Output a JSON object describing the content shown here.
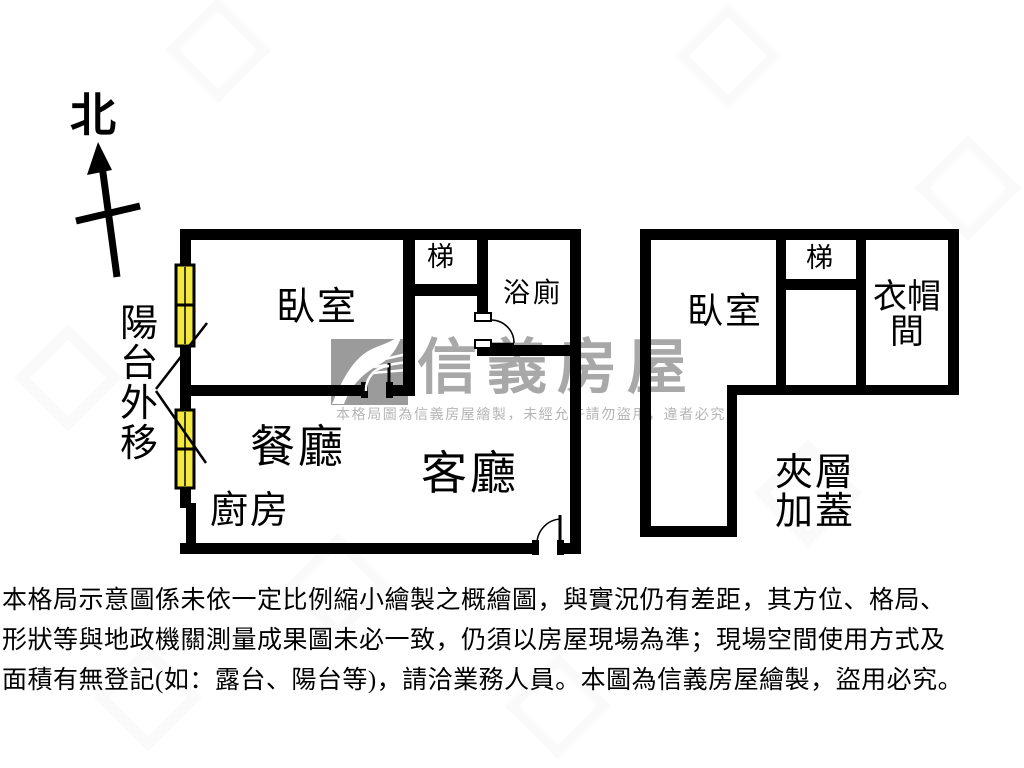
{
  "compass": {
    "label": "北"
  },
  "watermark": {
    "brand": "信義房屋",
    "notice": "本格局圖為信義房屋繪製，未經允許請勿盜用，違者必究",
    "brand_color": "#a8a8a8",
    "logo_color": "#9b9b9b"
  },
  "left_plan": {
    "rooms": {
      "bedroom": "臥室",
      "stairs": "梯",
      "bathroom": "浴廁",
      "dining": "餐廳",
      "living": "客廳",
      "kitchen": "廚房",
      "balcony_note": "陽台外移"
    }
  },
  "right_plan": {
    "rooms": {
      "bedroom": "臥室",
      "stairs": "梯",
      "closet": "衣帽間",
      "mezzanine": "夾層加蓋"
    }
  },
  "disclaimer": {
    "line1": "本格局示意圖係未依一定比例縮小繪製之概繪圖，與實況仍有差距，其方位、格局、",
    "line2": "形狀等與地政機關測量成果圖未必一致，仍須以房屋現場為準；現場空間使用方式及",
    "line3": "面積有無登記(如：露台、陽台等)，請洽業務人員。本圖為信義房屋繪製，盜用必究。"
  },
  "colors": {
    "wall": "#000000",
    "window": "#f2e93c"
  }
}
